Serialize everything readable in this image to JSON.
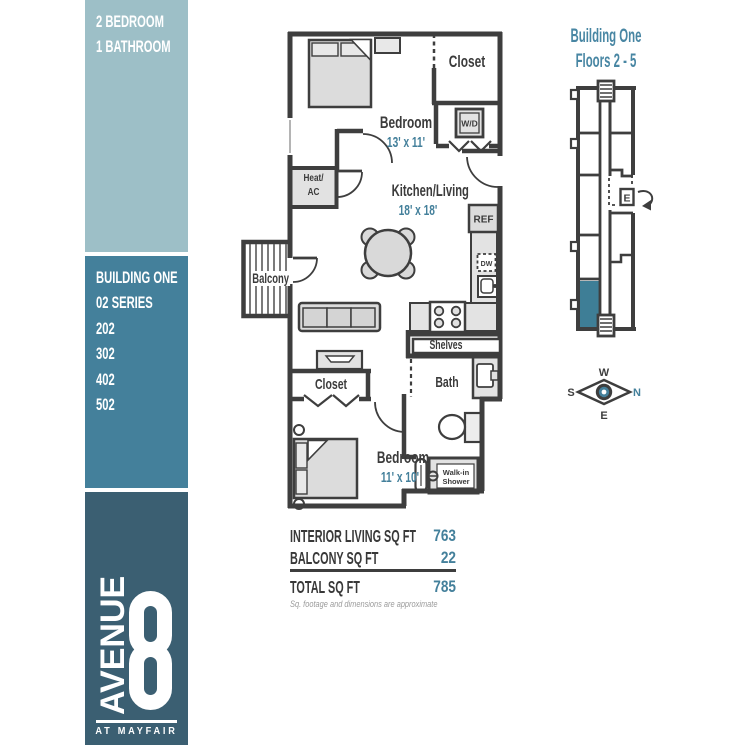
{
  "sidebar": {
    "unit_type": [
      "2 BEDROOM",
      "1 BATHROOM"
    ],
    "building": {
      "line1": "BUILDING ONE",
      "line2": "02 SERIES",
      "units": [
        "202",
        "302",
        "402",
        "502"
      ]
    },
    "logo": {
      "word": "AVENUE",
      "numeral": "8",
      "tagline": "AT MAYFAIR"
    }
  },
  "plan": {
    "bedroom1": {
      "label": "Bedroom",
      "dims": "13' x 11'"
    },
    "closet1": "Closet",
    "wd": "W/D",
    "heat_ac": [
      "Heat/",
      "AC"
    ],
    "kitchen": {
      "label": "Kitchen/Living",
      "dims": "18' x 18'"
    },
    "ref": "REF",
    "dw": "DW",
    "balcony": "Balcony",
    "shelves": "Shelves",
    "bath": "Bath",
    "closet2": "Closet",
    "bedroom2": {
      "label": "Bedroom",
      "dims": "11' x 10'"
    },
    "shower": [
      "Walk-in",
      "Shower"
    ]
  },
  "summary": {
    "rows": [
      {
        "label": "INTERIOR LIVING SQ FT",
        "value": "763"
      },
      {
        "label": "BALCONY SQ FT",
        "value": "22"
      }
    ],
    "total": {
      "label": "TOTAL SQ FT",
      "value": "785"
    },
    "disclaimer": "Sq. footage and dimensions are approximate"
  },
  "map": {
    "title_line1": "Building One",
    "title_line2": "Floors 2 - 5",
    "elevator": "E"
  },
  "compass": {
    "n": "N",
    "e": "E",
    "s": "S",
    "w": "W"
  },
  "colors": {
    "light_teal": "#9dbfc7",
    "teal": "#44809b",
    "dark_slate": "#3b5f72",
    "accent_text": "#44809b",
    "wall": "#3e3e3e",
    "highlight_unit": "#3e7e96"
  }
}
